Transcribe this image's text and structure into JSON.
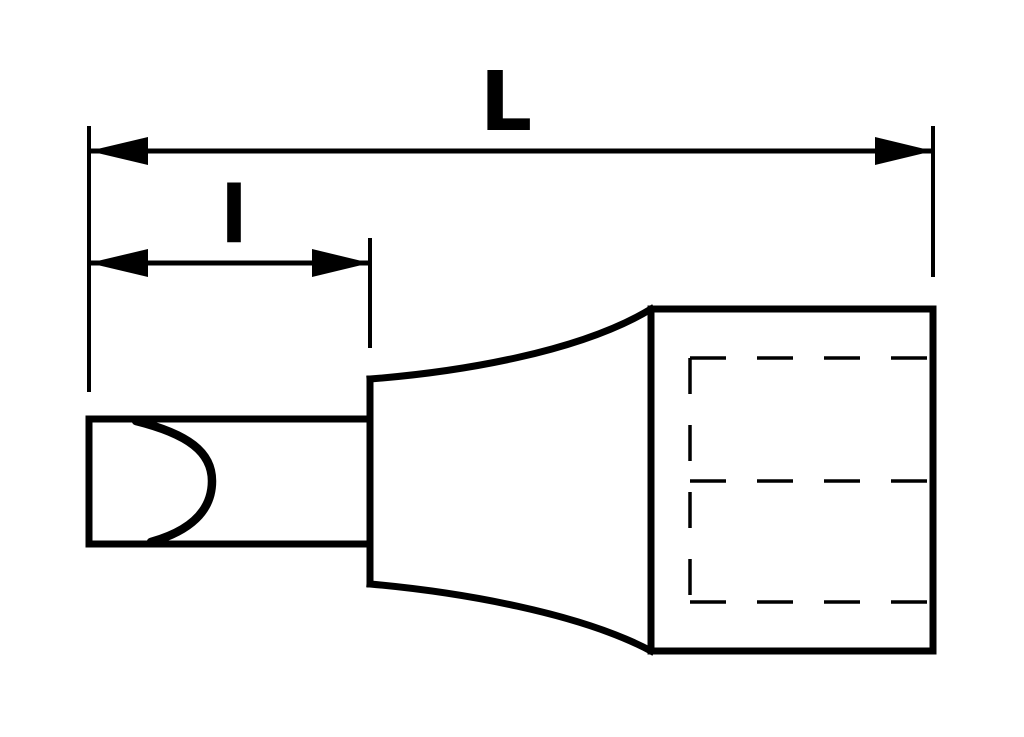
{
  "drawing": {
    "background_color": "#ffffff",
    "ink_color": "#000000",
    "labels": {
      "overall_length": "L",
      "tip_length": "l"
    }
  }
}
